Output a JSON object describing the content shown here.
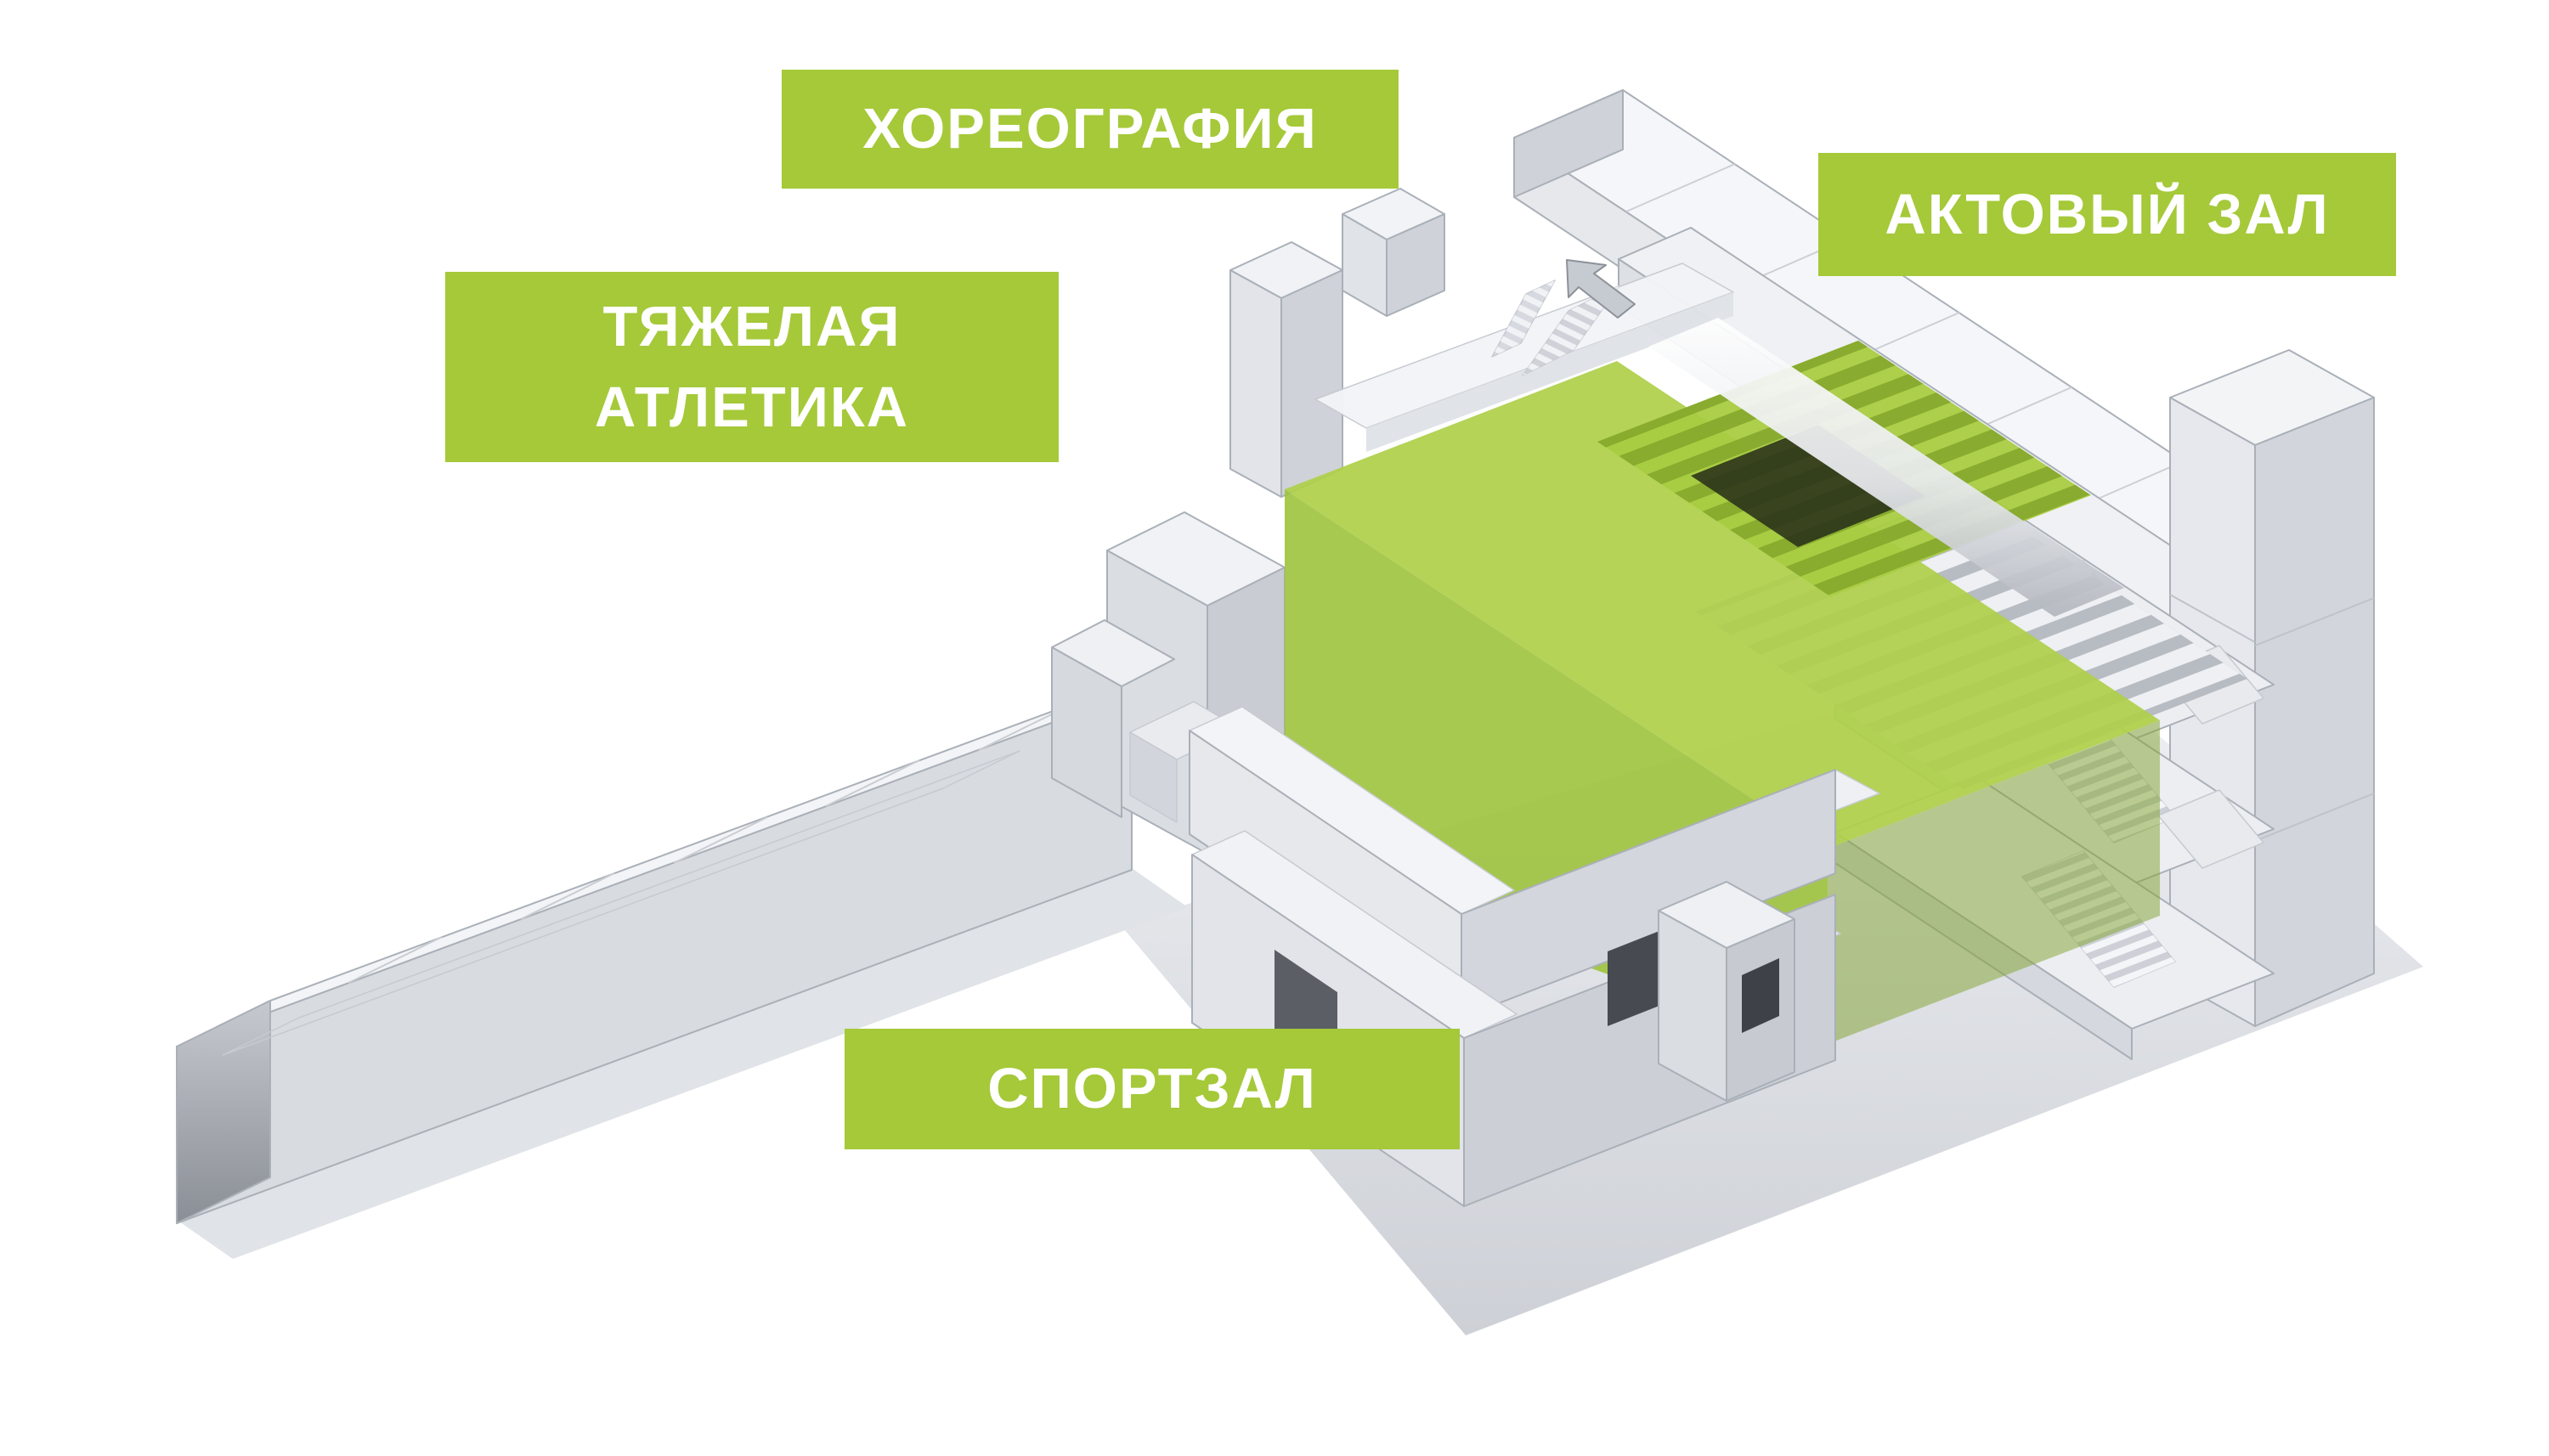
{
  "page": {
    "background_color": "#ffffff",
    "description": "Axonometric cutaway diagram of a school building with functional zones labeled; the assembly hall volume is highlighted in green"
  },
  "palette": {
    "label_green": "#a5c939",
    "highlight_green_top": "#aed04a",
    "highlight_green_front": "#9cc138",
    "highlight_green_side": "#7fa22c",
    "white_face": "#f4f5f8",
    "light_face": "#e6e8ec",
    "mid_face": "#d3d6dc",
    "dark_face": "#b9bdc4",
    "recess_dark": "#3e4147",
    "outline": "#aab0b8"
  },
  "labels": {
    "choreography": {
      "text": "ХОРЕОГРАФИЯ"
    },
    "weightlifting": {
      "line1": "ТЯЖЕЛАЯ",
      "line2": "АТЛЕТИКА"
    },
    "assembly_hall": {
      "text": "АКТОВЫЙ ЗАЛ"
    },
    "gym": {
      "text": "СПОРТЗАЛ"
    }
  },
  "building": {
    "highlighted_zone": "АКТОВЫЙ ЗАЛ"
  }
}
